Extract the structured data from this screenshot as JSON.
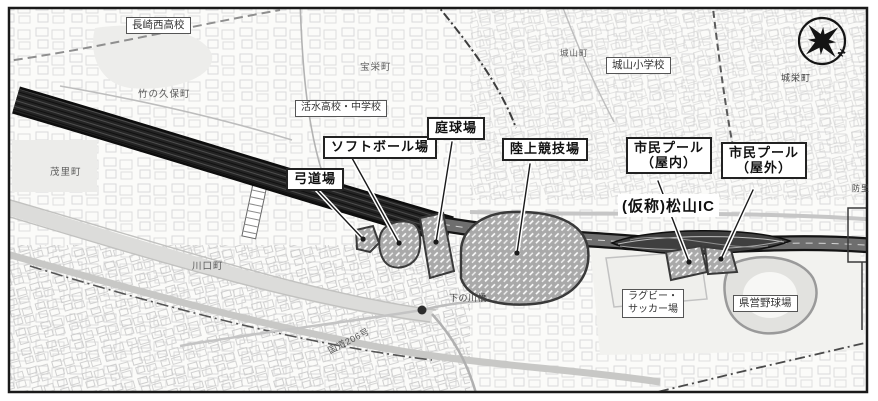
{
  "labels": {
    "facilities": [
      {
        "id": "archery",
        "text": "弓道場"
      },
      {
        "id": "softball",
        "text": "ソフトボール場"
      },
      {
        "id": "tennis",
        "text": "庭球場"
      },
      {
        "id": "athletics",
        "text": "陸上競技場"
      },
      {
        "id": "pool_indoor",
        "line1": "市民プール",
        "line2": "（屋内）"
      },
      {
        "id": "pool_outdoor",
        "line1": "市民プール",
        "line2": "（屋外）"
      }
    ],
    "ic": "(仮称)松山IC",
    "landmarks": [
      {
        "id": "nishi_hs",
        "text": "長崎西高校"
      },
      {
        "id": "shiroyama_es",
        "text": "城山小学校"
      },
      {
        "id": "kassui",
        "text": "活水高校・中学校"
      },
      {
        "id": "rugby",
        "line1": "ラグビー・",
        "line2": "サッカー場"
      },
      {
        "id": "baseball",
        "text": "県営野球場"
      }
    ],
    "places": [
      {
        "id": "takenokubo",
        "text": "竹の久保町"
      },
      {
        "id": "hoei",
        "text": "宝栄町"
      },
      {
        "id": "shiroyama",
        "text": "城山町"
      },
      {
        "id": "joei",
        "text": "城栄町"
      },
      {
        "id": "mori",
        "text": "茂里町"
      },
      {
        "id": "kawaguchi",
        "text": "川口町"
      },
      {
        "id": "edge_partial",
        "text": "防里"
      }
    ],
    "roads": [
      {
        "id": "shimonokawa_bridge",
        "text": "下の川橋"
      },
      {
        "id": "route206",
        "text": "国道206号"
      }
    ],
    "compass_letter": "N"
  },
  "colors": {
    "frame": "#1a1a1a",
    "tunnel_band": "#1c1c1c",
    "road_fill": "#6e6e6e",
    "facility_fill": "#a9a9a9",
    "facility_outline": "#3a3a3a",
    "base_texture": "#d2d2d2"
  }
}
